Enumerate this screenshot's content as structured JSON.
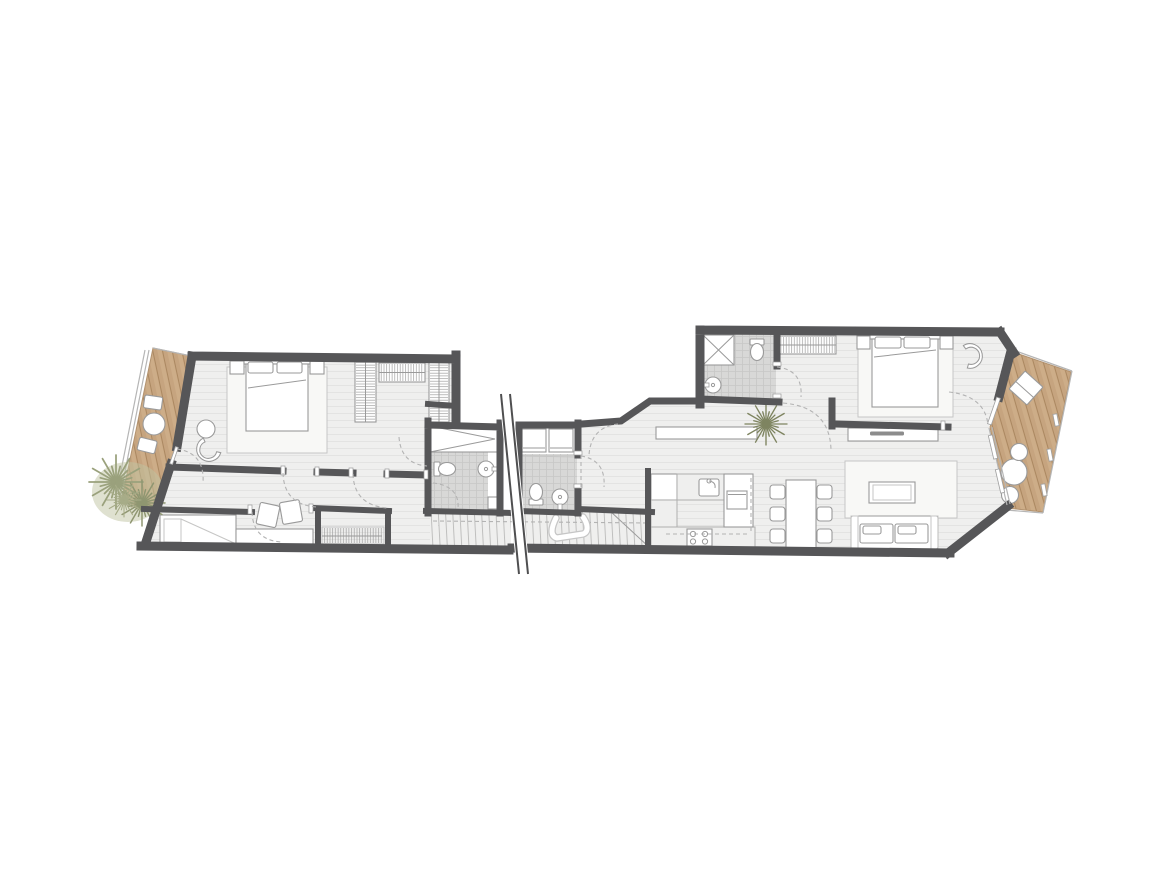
{
  "plan": {
    "type": "apartment-floor-plan",
    "units": [
      {
        "name": "left-apartment",
        "rooms": [
          {
            "name": "west-terrace",
            "floor": "wood-deck",
            "furniture": [
              "bistro-table",
              "terrace-chair",
              "terrace-chair",
              "olive-tree"
            ]
          },
          {
            "name": "master-bedroom",
            "furniture": [
              "double-bed",
              "rug",
              "nightstand",
              "nightstand",
              "round-pouf",
              "chaise-longue"
            ]
          },
          {
            "name": "walk-in-wardrobe",
            "furniture": [
              "shelf-column",
              "hanging-rail",
              "shelf-column"
            ]
          },
          {
            "name": "hallway",
            "features": [
              "door-swings"
            ]
          },
          {
            "name": "second-bedroom",
            "furniture": [
              "daybed",
              "bench",
              "cushion",
              "cushion",
              "built-in-closet"
            ]
          },
          {
            "name": "bathroom-1",
            "furniture": [
              "shower",
              "toilet",
              "washbasin",
              "base-cabinet"
            ],
            "floor": "tile"
          }
        ]
      },
      {
        "name": "right-apartment",
        "rooms": [
          {
            "name": "entry-hall",
            "furniture": [
              "sideboard",
              "potted-palm"
            ]
          },
          {
            "name": "bathroom-2",
            "furniture": [
              "washer",
              "dryer",
              "toilet",
              "washbasin"
            ],
            "floor": "tile"
          },
          {
            "name": "bathroom-3",
            "furniture": [
              "shower",
              "toilet",
              "washbasin"
            ],
            "floor": "tile"
          },
          {
            "name": "bedroom",
            "furniture": [
              "double-bed",
              "rug",
              "nightstand",
              "nightstand",
              "armchair",
              "wardrobe-rail"
            ]
          },
          {
            "name": "living-room",
            "furniture": [
              "sofa",
              "coffee-table",
              "rug",
              "tv-sideboard"
            ]
          },
          {
            "name": "dining-area",
            "furniture": [
              "dining-table",
              "chair",
              "chair",
              "chair",
              "chair",
              "chair",
              "chair"
            ]
          },
          {
            "name": "kitchen",
            "furniture": [
              "tall-unit",
              "sink",
              "hob",
              "oven",
              "peninsula-counter"
            ]
          },
          {
            "name": "east-terrace",
            "floor": "wood-deck",
            "furniture": [
              "lounge-chair",
              "round-table",
              "chair",
              "chair"
            ]
          }
        ]
      }
    ],
    "shared_features": [
      "staircase-with-handrail",
      "section-break-line"
    ]
  },
  "colors": {
    "wall": "#565658",
    "floor": "#efefee",
    "plankLine": "#e3e3e2",
    "tile": "#d8d8d7",
    "tileLine": "#c7c7c6",
    "wood": "#c6a47f",
    "woodLine": "#a8855e",
    "woodLight": "#d8bb97",
    "rug": "#f8f8f6",
    "line": "#9a9a9a",
    "lineLight": "#c6c6c5",
    "dash": "#b3b3b3",
    "tread": "#bfbfbe",
    "foliage": "#bfc3a1",
    "foliageDark": "#8f9571"
  }
}
